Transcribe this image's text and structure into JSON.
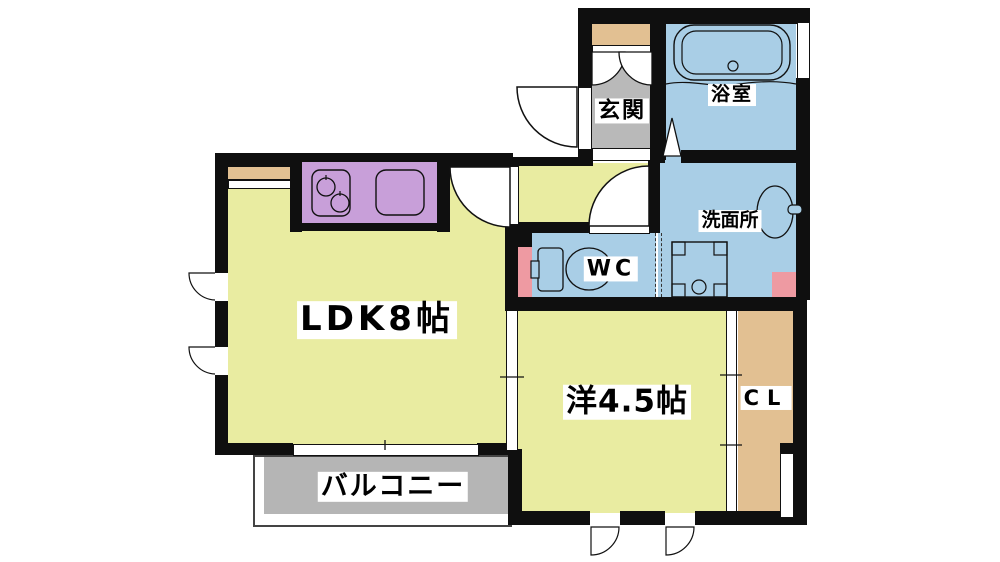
{
  "labels": {
    "ldk": "LDK8帖",
    "western_room": "洋4.5帖",
    "closet": "CL",
    "balcony": "バルコニー",
    "entrance": "玄関",
    "bathroom": "浴室",
    "washroom": "洗面所",
    "toilet": "WC"
  },
  "colors": {
    "room_yellow": "#e9eca1",
    "water_blue": "#a9cee6",
    "kitchen_purple": "#c89fd9",
    "closet_tan": "#e2c092",
    "pipe_pink": "#ee9aa2",
    "floor_gray": "#b9b9b9",
    "wall_black": "#0f0f0f"
  }
}
